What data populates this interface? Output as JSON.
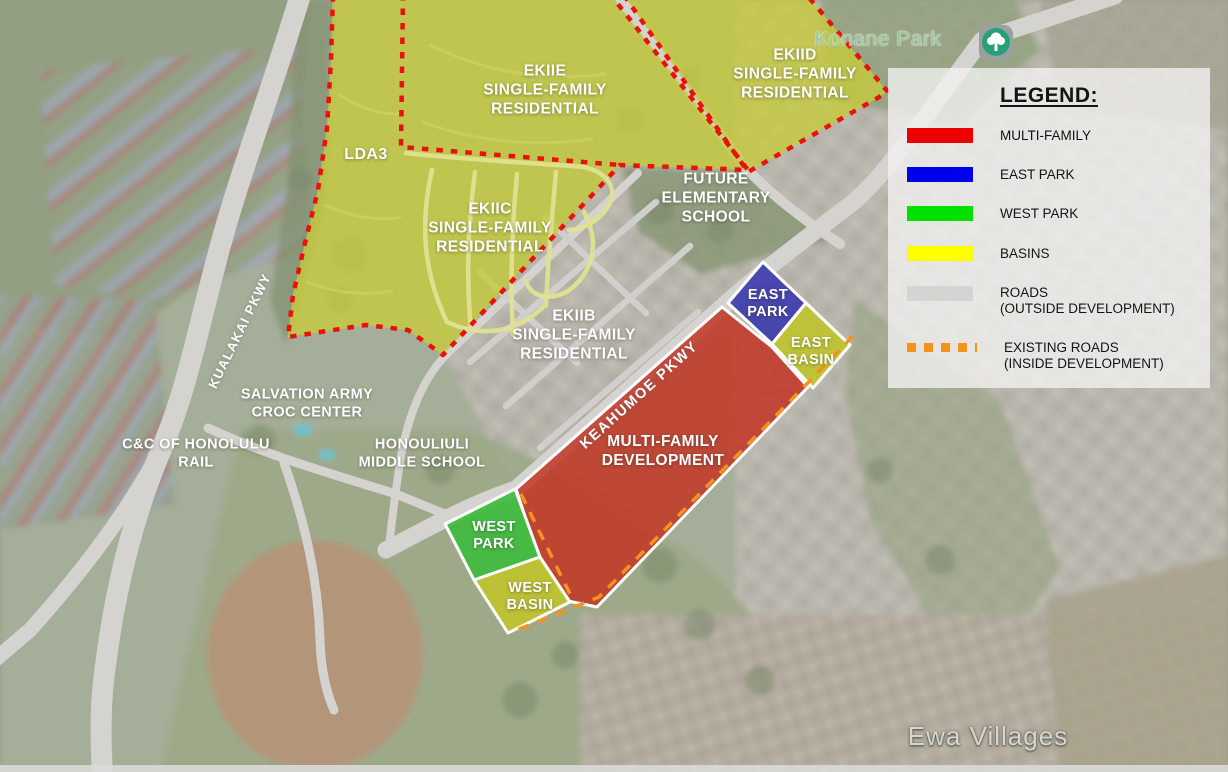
{
  "map": {
    "zones": {
      "lda3": {
        "label": "LDA3",
        "fill": "#c6ca3c"
      },
      "ekiie": {
        "label": "EKIIE\nSINGLE-FAMILY\nRESIDENTIAL",
        "fill": "#c6ca3c"
      },
      "ekiic": {
        "label": "EKIIC\nSINGLE-FAMILY\nRESIDENTIAL",
        "fill": "#c6ca3c"
      },
      "ekiid": {
        "label": "EKIID\nSINGLE-FAMILY\nRESIDENTIAL",
        "fill": "#c6ca3c"
      },
      "ekiib": {
        "label": "EKIIB\nSINGLE-FAMILY\nRESIDENTIAL"
      },
      "future_school": {
        "label": "FUTURE\nELEMENTARY\nSCHOOL"
      },
      "multi_family": {
        "label": "MULTI-FAMILY\nDEVELOPMENT",
        "fill": "#c23524"
      },
      "east_park": {
        "label": "EAST\nPARK",
        "fill": "#3d3dac"
      },
      "east_basin": {
        "label": "EAST\nBASIN",
        "fill": "#bfc32f"
      },
      "west_park": {
        "label": "WEST\nPARK",
        "fill": "#3fbc3f"
      },
      "west_basin": {
        "label": "WEST\nBASIN",
        "fill": "#bfc32f"
      }
    },
    "landmarks": {
      "salvation_army": "SALVATION ARMY\nCROC CENTER",
      "honolulu_rail": "C&C OF HONOLULU\nRAIL",
      "middle_school": "HONOULIULI\nMIDDLE SCHOOL",
      "konane_park": "Konane Park",
      "ewa_villages": "Ewa Villages"
    },
    "roads": {
      "kualakai": "KUALAKAI PKWY",
      "keahumoe": "KEAHUMOE PKWY"
    },
    "line_colors": {
      "zone_boundary_dotted": "#e91208",
      "existing_road_dashed": "#f5921e",
      "zone_border_white": "#ffffff",
      "road_gray": "#d5d3d0"
    }
  },
  "legend": {
    "title": "LEGEND:",
    "items": [
      {
        "label": "MULTI-FAMILY",
        "swatch": "solid",
        "color": "#ee0000"
      },
      {
        "label": "EAST PARK",
        "swatch": "solid",
        "color": "#0000ee"
      },
      {
        "label": "WEST PARK",
        "swatch": "solid",
        "color": "#00e000"
      },
      {
        "label": "BASINS",
        "swatch": "solid",
        "color": "#ffff00"
      },
      {
        "label": "ROADS\n(OUTSIDE DEVELOPMENT)",
        "swatch": "solid",
        "color": "#d4d4d2"
      },
      {
        "label": "EXISTING ROADS\n(INSIDE DEVELOPMENT)",
        "swatch": "dashed",
        "color": "#f5921e"
      }
    ]
  }
}
